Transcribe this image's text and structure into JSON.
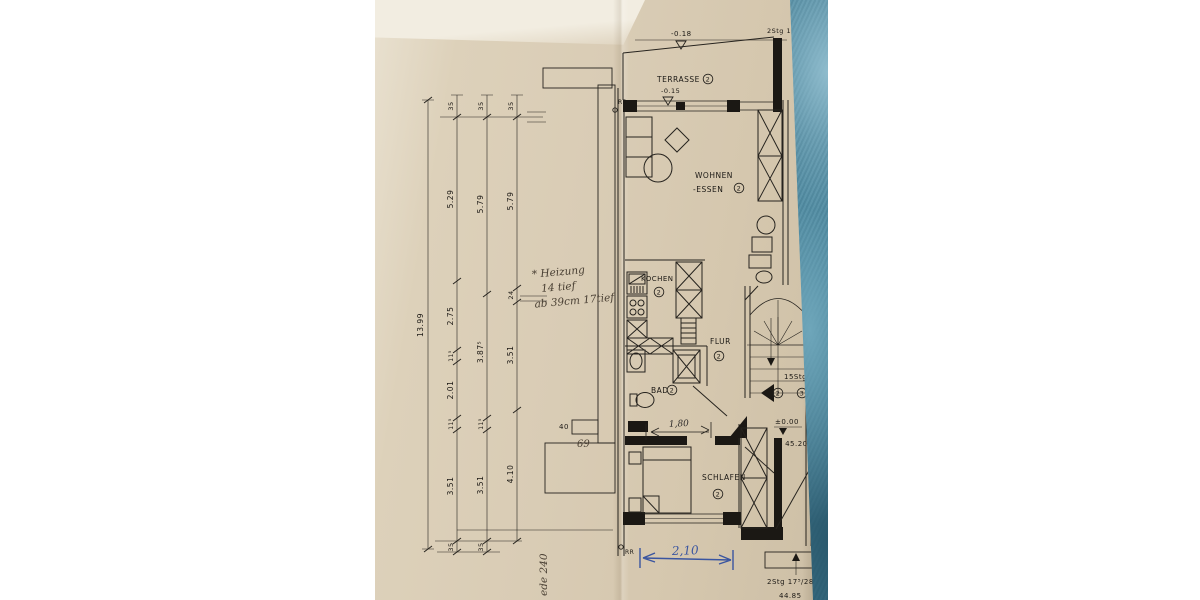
{
  "photo": {
    "description": "photograph of a paper architectural floor plan lying on a teal leather surface",
    "paper_color": "#d9ccb5",
    "desk_color": "#3f7d95",
    "ink_color": "#1b1814",
    "pen_blue": "#3a55a0"
  },
  "labels": {
    "terrasse": "TERRASSE",
    "wohnen": "WOHNEN",
    "essen": "-ESSEN",
    "kochen": "KOCHEN",
    "flur": "FLUR",
    "bad": "BAD",
    "schlafen": "SCHLAFEN",
    "rr_top": "RR",
    "rr_bottom": "RR",
    "stg_top": "2Stg 1",
    "stg_15": "15Stg",
    "stg_bottom": "2Stg 17⁵/28",
    "level_minus018": "-0.18",
    "level_minus015": "-0.15",
    "level_zero": "±0.00",
    "level_4520": "= 45.20",
    "level_4485": "44.85",
    "unit2": "2",
    "unit3": "3"
  },
  "dimensions": {
    "overall": "13.99",
    "chain2": [
      "35",
      "5.29",
      "2.75",
      "11⁵",
      "2.01",
      "11⁵",
      "3.51",
      "35"
    ],
    "chain3": [
      "35",
      "5.79",
      "3.87⁵",
      "11⁵",
      "3.51",
      "35"
    ],
    "chain4": [
      "35",
      "5.79",
      "24",
      "3.51",
      "4.10"
    ],
    "width_180": "1,80",
    "width_210": "2,10",
    "radiator_width": "40"
  },
  "handwriting": {
    "heizung_line1": "* Heizung",
    "heizung_line2": "14 tief",
    "heizung_line3": "ab 39cm 17tief",
    "note_69": "69",
    "note_bottom": "ede 240"
  }
}
